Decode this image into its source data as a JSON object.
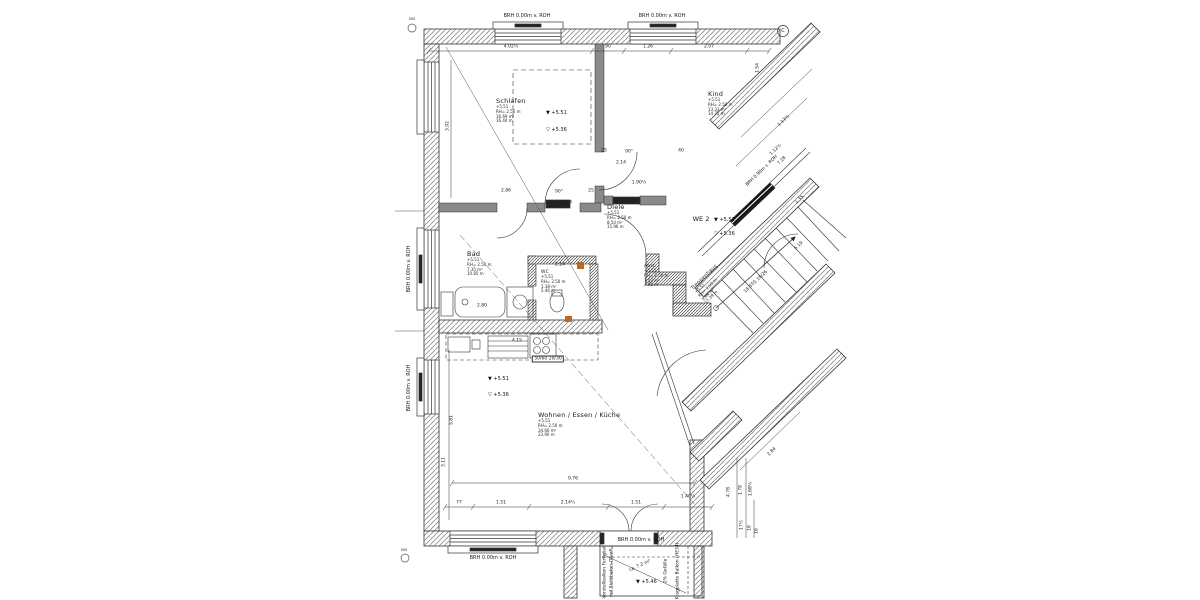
{
  "drawing": {
    "type": "floor-plan",
    "unit_label": "WE 2",
    "accent_color": "#c06820",
    "line_color": "#333333",
    "rooms": [
      {
        "name": "Schlafen",
        "lines": [
          "+5.51",
          "RH= 2.50 m",
          "16.69 m²",
          "16.44 m"
        ],
        "x": 496,
        "y": 97
      },
      {
        "name": "Kind",
        "lines": [
          "+5.51",
          "RH= 2.50 m",
          "13.33 m²",
          "14.75 m"
        ],
        "x": 708,
        "y": 90
      },
      {
        "name": "Diele",
        "lines": [
          "+5.51",
          "RH= 2.50 m",
          "8.54 m²",
          "15.96 m"
        ],
        "x": 607,
        "y": 203
      },
      {
        "name": "Bad",
        "lines": [
          "+5.51",
          "RH= 2.50 m",
          "7.35 m²",
          "10.85 m"
        ],
        "x": 467,
        "y": 250
      },
      {
        "name": "WC",
        "fs": 4.5,
        "lines": [
          "+5.51",
          "RH= 2.50 m",
          "1.38 m²",
          "5.46 m"
        ],
        "x": 541,
        "y": 270
      },
      {
        "name": "Abst.",
        "fs": 4.5,
        "lines": [
          "+5.51",
          "RH= 2.50 m",
          "1.52 m²",
          "4.95 m"
        ],
        "x": 644,
        "y": 264
      },
      {
        "name": "Wohnen / Essen / Küche",
        "lines": [
          "+5.51",
          "RH= 2.50 m",
          "34.66 m²",
          "23.90 m"
        ],
        "x": 538,
        "y": 411
      },
      {
        "name": "Treppenhaus",
        "fs": 5,
        "rot": -44,
        "lines": [
          "+5.51",
          "RH= 2.50 m",
          "9.84 m²",
          "11.39 m"
        ],
        "x": 690,
        "y": 287
      }
    ],
    "level_markers": [
      {
        "style": "filled",
        "text": "+5.51",
        "x": 546,
        "y": 113
      },
      {
        "style": "open",
        "text": "+5.36",
        "x": 546,
        "y": 130
      },
      {
        "style": "filled",
        "text": "+5.51",
        "x": 714,
        "y": 220
      },
      {
        "style": "open",
        "text": "+5.36",
        "x": 714,
        "y": 234
      },
      {
        "style": "filled",
        "text": "+5.51",
        "x": 488,
        "y": 379
      },
      {
        "style": "open",
        "text": "+5.36",
        "x": 488,
        "y": 395
      },
      {
        "style": "filled",
        "text": "+5.46",
        "x": 636,
        "y": 582
      }
    ],
    "annotations": [
      {
        "t": "BRH 0.00m v. ROH",
        "x": 527,
        "y": 16,
        "fs": 5
      },
      {
        "t": "BRH 0.00m v. ROH",
        "x": 662,
        "y": 16,
        "fs": 5
      },
      {
        "t": "BRH 0.00m v. ROH",
        "x": 409,
        "y": 269,
        "r": -90,
        "fs": 5
      },
      {
        "t": "BRH 0.00m v. ROH",
        "x": 409,
        "y": 388,
        "r": -90,
        "fs": 5
      },
      {
        "t": "BRH 0.00m v. ROH",
        "x": 493,
        "y": 558,
        "fs": 5
      },
      {
        "t": "BRH 0.00m v. ROH",
        "x": 641,
        "y": 540,
        "fs": 5
      },
      {
        "t": "BRH 0.90m v. ROH",
        "x": 762,
        "y": 171,
        "r": -44
      },
      {
        "t": "WE 2",
        "x": 701,
        "y": 219,
        "fs": 6.5
      },
      {
        "t": "18 STG 18/26",
        "x": 756,
        "y": 282,
        "r": -44
      },
      {
        "t": "50/60 20/30",
        "x": 548,
        "y": 359,
        "box": true
      },
      {
        "t": "Vorstellbalkon Fertigteil",
        "x": 605,
        "y": 572,
        "r": -90
      },
      {
        "t": "mit Sichtbeton-Oberfl.",
        "x": 612,
        "y": 572,
        "r": -90
      },
      {
        "t": "2% Gefälle",
        "x": 666,
        "y": 571,
        "r": -90
      },
      {
        "t": "Kragplatte Balkon (HE34)",
        "x": 678,
        "y": 571,
        "r": -90
      },
      {
        "t": "ca. 7.2 m²",
        "x": 640,
        "y": 566,
        "r": -24
      },
      {
        "t": "C",
        "x": 783,
        "y": 31,
        "fs": 5
      },
      {
        "t": "500",
        "x": 412,
        "y": 19,
        "fs": 3.5
      },
      {
        "t": "500",
        "x": 404,
        "y": 550,
        "fs": 3.5
      },
      {
        "t": "4.02½",
        "x": 511,
        "y": 47
      },
      {
        "t": "90",
        "x": 608,
        "y": 47
      },
      {
        "t": "1.26",
        "x": 648,
        "y": 47
      },
      {
        "t": "2.07",
        "x": 709,
        "y": 47
      },
      {
        "t": "1.54",
        "x": 758,
        "y": 68,
        "r": -90
      },
      {
        "t": "3.92",
        "x": 448,
        "y": 126,
        "r": -90
      },
      {
        "t": "2.86",
        "x": 506,
        "y": 191
      },
      {
        "t": "90°",
        "x": 559,
        "y": 192
      },
      {
        "t": "2.14",
        "x": 567,
        "y": 203
      },
      {
        "t": "25",
        "x": 591,
        "y": 191
      },
      {
        "t": "25",
        "x": 604,
        "y": 151
      },
      {
        "t": "2.14",
        "x": 621,
        "y": 163
      },
      {
        "t": "90°",
        "x": 629,
        "y": 152
      },
      {
        "t": "40",
        "x": 681,
        "y": 151
      },
      {
        "t": "1.90½",
        "x": 639,
        "y": 183
      },
      {
        "t": "2.80",
        "x": 482,
        "y": 306
      },
      {
        "t": "2.14",
        "x": 560,
        "y": 265
      },
      {
        "t": "4.15",
        "x": 517,
        "y": 341
      },
      {
        "t": "9.76",
        "x": 573,
        "y": 479
      },
      {
        "t": "77",
        "x": 459,
        "y": 503
      },
      {
        "t": "1.51",
        "x": 501,
        "y": 503
      },
      {
        "t": "2.14½",
        "x": 568,
        "y": 503
      },
      {
        "t": "1.51",
        "x": 636,
        "y": 503
      },
      {
        "t": "1.40½",
        "x": 688,
        "y": 497
      },
      {
        "t": "5.81",
        "x": 452,
        "y": 420,
        "r": -90
      },
      {
        "t": "3.11",
        "x": 444,
        "y": 462,
        "r": -90
      },
      {
        "t": "4.78",
        "x": 729,
        "y": 492,
        "r": -90
      },
      {
        "t": "1.78",
        "x": 741,
        "y": 490,
        "r": -90
      },
      {
        "t": "1.68½",
        "x": 751,
        "y": 489,
        "r": -90
      },
      {
        "t": "17½",
        "x": 742,
        "y": 525,
        "r": -90
      },
      {
        "t": "18",
        "x": 750,
        "y": 528,
        "r": -90
      },
      {
        "t": "16",
        "x": 757,
        "y": 531,
        "r": -90
      },
      {
        "t": "1.13½",
        "x": 784,
        "y": 121,
        "r": -44
      },
      {
        "t": "1.12½",
        "x": 776,
        "y": 150,
        "r": -44
      },
      {
        "t": "7.28",
        "x": 782,
        "y": 161,
        "r": -44
      },
      {
        "t": "1.35",
        "x": 800,
        "y": 200,
        "r": -44
      },
      {
        "t": "5.19",
        "x": 799,
        "y": 246,
        "r": -44
      },
      {
        "t": "2.84",
        "x": 772,
        "y": 452,
        "r": -44
      }
    ]
  }
}
